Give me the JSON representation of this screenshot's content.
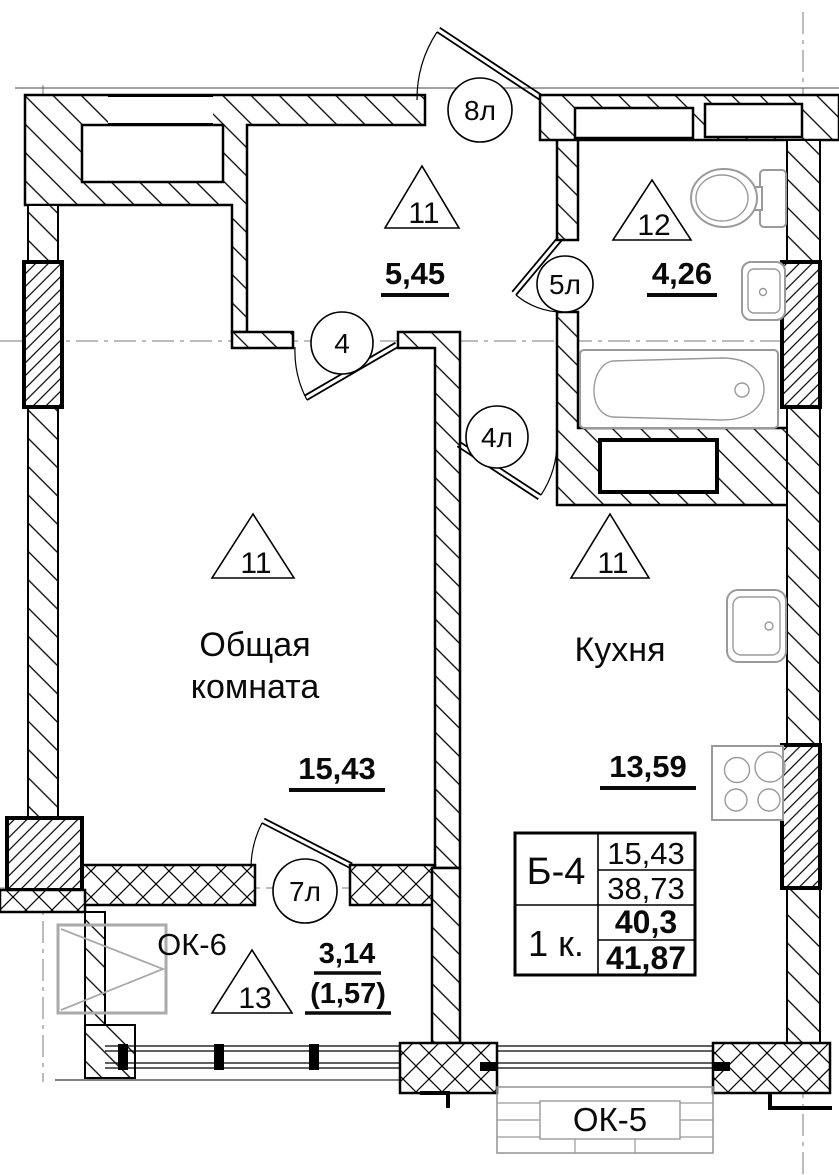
{
  "rooms": {
    "hall": {
      "zone": "11",
      "area": "5,45"
    },
    "bathroom": {
      "zone": "12",
      "area": "4,26"
    },
    "living": {
      "zone": "11",
      "name1": "Общая",
      "name2": "комната",
      "area": "15,43"
    },
    "kitchen": {
      "zone": "11",
      "name": "Кухня",
      "area": "13,59"
    },
    "loggia": {
      "zone": "13",
      "area": "3,14",
      "area_coeff": "(1,57)"
    }
  },
  "doors": {
    "entrance": "8л",
    "living": "4",
    "kitchen": "4л",
    "bathroom": "5л",
    "loggia": "7л"
  },
  "windows": {
    "loggia": "ОК-6",
    "kitchen": "ОК-5"
  },
  "info_table": {
    "unit": "Б-4",
    "living_area": "15,43",
    "sum_area": "38,73",
    "rooms": "1 к.",
    "total_area": "40,3",
    "total_with_balcony": "41,87"
  }
}
